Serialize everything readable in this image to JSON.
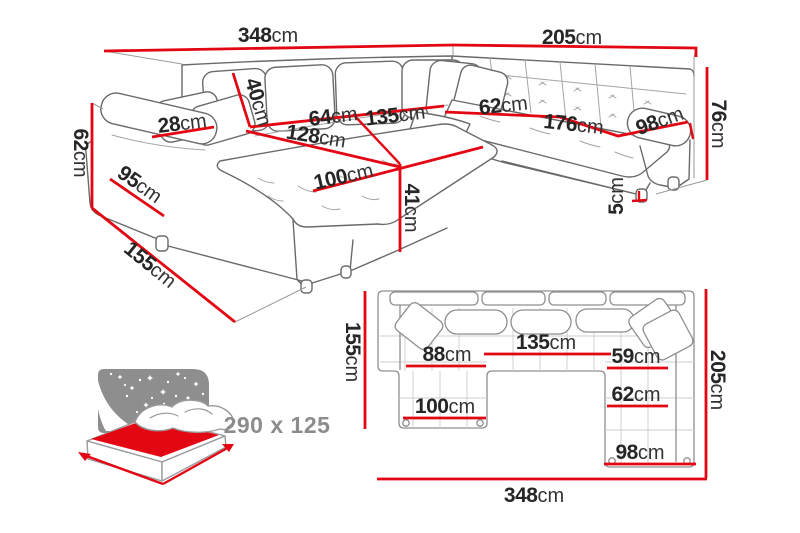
{
  "colors": {
    "dimension_red": "#e30613",
    "text_dark": "#262626",
    "label_gray": "#8c8c8c",
    "line_gray": "#6a6a6a"
  },
  "perspective_view": {
    "title": "corner sofa dimensions - perspective view",
    "dims": {
      "width_left": {
        "num": "348",
        "unit": "cm"
      },
      "width_right": {
        "num": "205",
        "unit": "cm"
      },
      "back_cushion": {
        "num": "40",
        "unit": "cm"
      },
      "armrest_top": {
        "num": "28",
        "unit": "cm"
      },
      "seat_depth_left": {
        "num": "64",
        "unit": "cm"
      },
      "seat_width_left": {
        "num": "135",
        "unit": "cm"
      },
      "chaise_length": {
        "num": "128",
        "unit": "cm"
      },
      "seat_depth_corner": {
        "num": "62",
        "unit": "cm"
      },
      "seat_width_right": {
        "num": "176",
        "unit": "cm"
      },
      "armrest_span": {
        "num": "98",
        "unit": "cm"
      },
      "height_right": {
        "num": "76",
        "unit": "cm"
      },
      "armrest_height": {
        "num": "62",
        "unit": "cm"
      },
      "armrest_depth": {
        "num": "95",
        "unit": "cm"
      },
      "chaise_cushion": {
        "num": "100",
        "unit": "cm"
      },
      "seat_height": {
        "num": "41",
        "unit": "cm"
      },
      "leg_height": {
        "num": "5",
        "unit": "cm"
      },
      "chaise_depth": {
        "num": "155",
        "unit": "cm"
      }
    }
  },
  "sleeping_area": {
    "size_label": "290 x 125"
  },
  "top_view": {
    "title": "corner sofa dimensions - top view",
    "dims": {
      "depth_left": {
        "num": "155",
        "unit": "cm"
      },
      "seat_left": {
        "num": "88",
        "unit": "cm"
      },
      "seat_middle": {
        "num": "135",
        "unit": "cm"
      },
      "seat_right": {
        "num": "59",
        "unit": "cm"
      },
      "depth_right": {
        "num": "205",
        "unit": "cm"
      },
      "chaise_width": {
        "num": "100",
        "unit": "cm"
      },
      "right_seat": {
        "num": "62",
        "unit": "cm"
      },
      "right_arm": {
        "num": "98",
        "unit": "cm"
      },
      "total_width": {
        "num": "348",
        "unit": "cm"
      }
    }
  }
}
